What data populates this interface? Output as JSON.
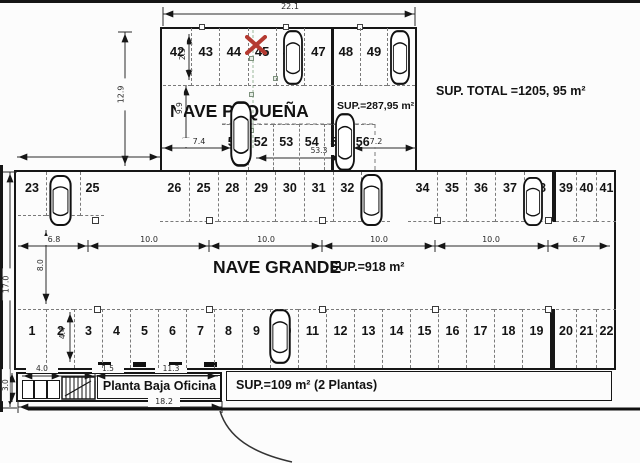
{
  "sup_total": "SUP. TOTAL =1205, 95 m²",
  "pequena": {
    "name": "NAVE PEQUEÑA",
    "sup_label": "SUP.=287,95 m²",
    "top_spots": [
      "42",
      "43",
      "44",
      "45",
      "46",
      "47",
      "48",
      "49",
      "50"
    ],
    "mid_spots": [
      "51",
      "52",
      "53",
      "54",
      "55",
      "56"
    ]
  },
  "grande": {
    "name": "NAVE GRANDE",
    "sup_label": "SUP.=918 m²",
    "mid_spots": [
      "23",
      "24",
      "25",
      "26",
      "25",
      "28",
      "29",
      "30",
      "31",
      "32",
      "33",
      "34",
      "35",
      "36",
      "37",
      "38",
      "39",
      "40",
      "41"
    ],
    "bottom_spots": [
      "1",
      "2",
      "3",
      "4",
      "5",
      "6",
      "7",
      "8",
      "9",
      "10",
      "11",
      "12",
      "13",
      "14",
      "15",
      "16",
      "17",
      "18",
      "19",
      "20",
      "21",
      "22"
    ]
  },
  "office": {
    "label": "Planta Baja Oficina",
    "sup_label": "SUP.=109 m² (2 Plantas)"
  },
  "dims": {
    "top_width": "22.1",
    "pequena_height": "12.9",
    "pequena_upper": "2.3",
    "pequena_lower": "9.9",
    "left_bay": "7.4",
    "mid_span": "53.3",
    "right_bay": "7.2",
    "grande_height": "17.0",
    "chain": [
      "6.8",
      "10.0",
      "10.0",
      "10.0",
      "10.0",
      "6.7"
    ],
    "inner_height": "8.0",
    "spot_depth": "4.4",
    "office_rooms": "4.0",
    "office_stair": "1.5",
    "office_main": "11.3",
    "office_total": "18.2",
    "office_height": "3.0"
  },
  "cars": [
    "46",
    "50",
    "51",
    "55",
    "24",
    "33",
    "38",
    "10"
  ],
  "colors": {
    "x_mark": "#b53a31",
    "line": "#161616"
  }
}
